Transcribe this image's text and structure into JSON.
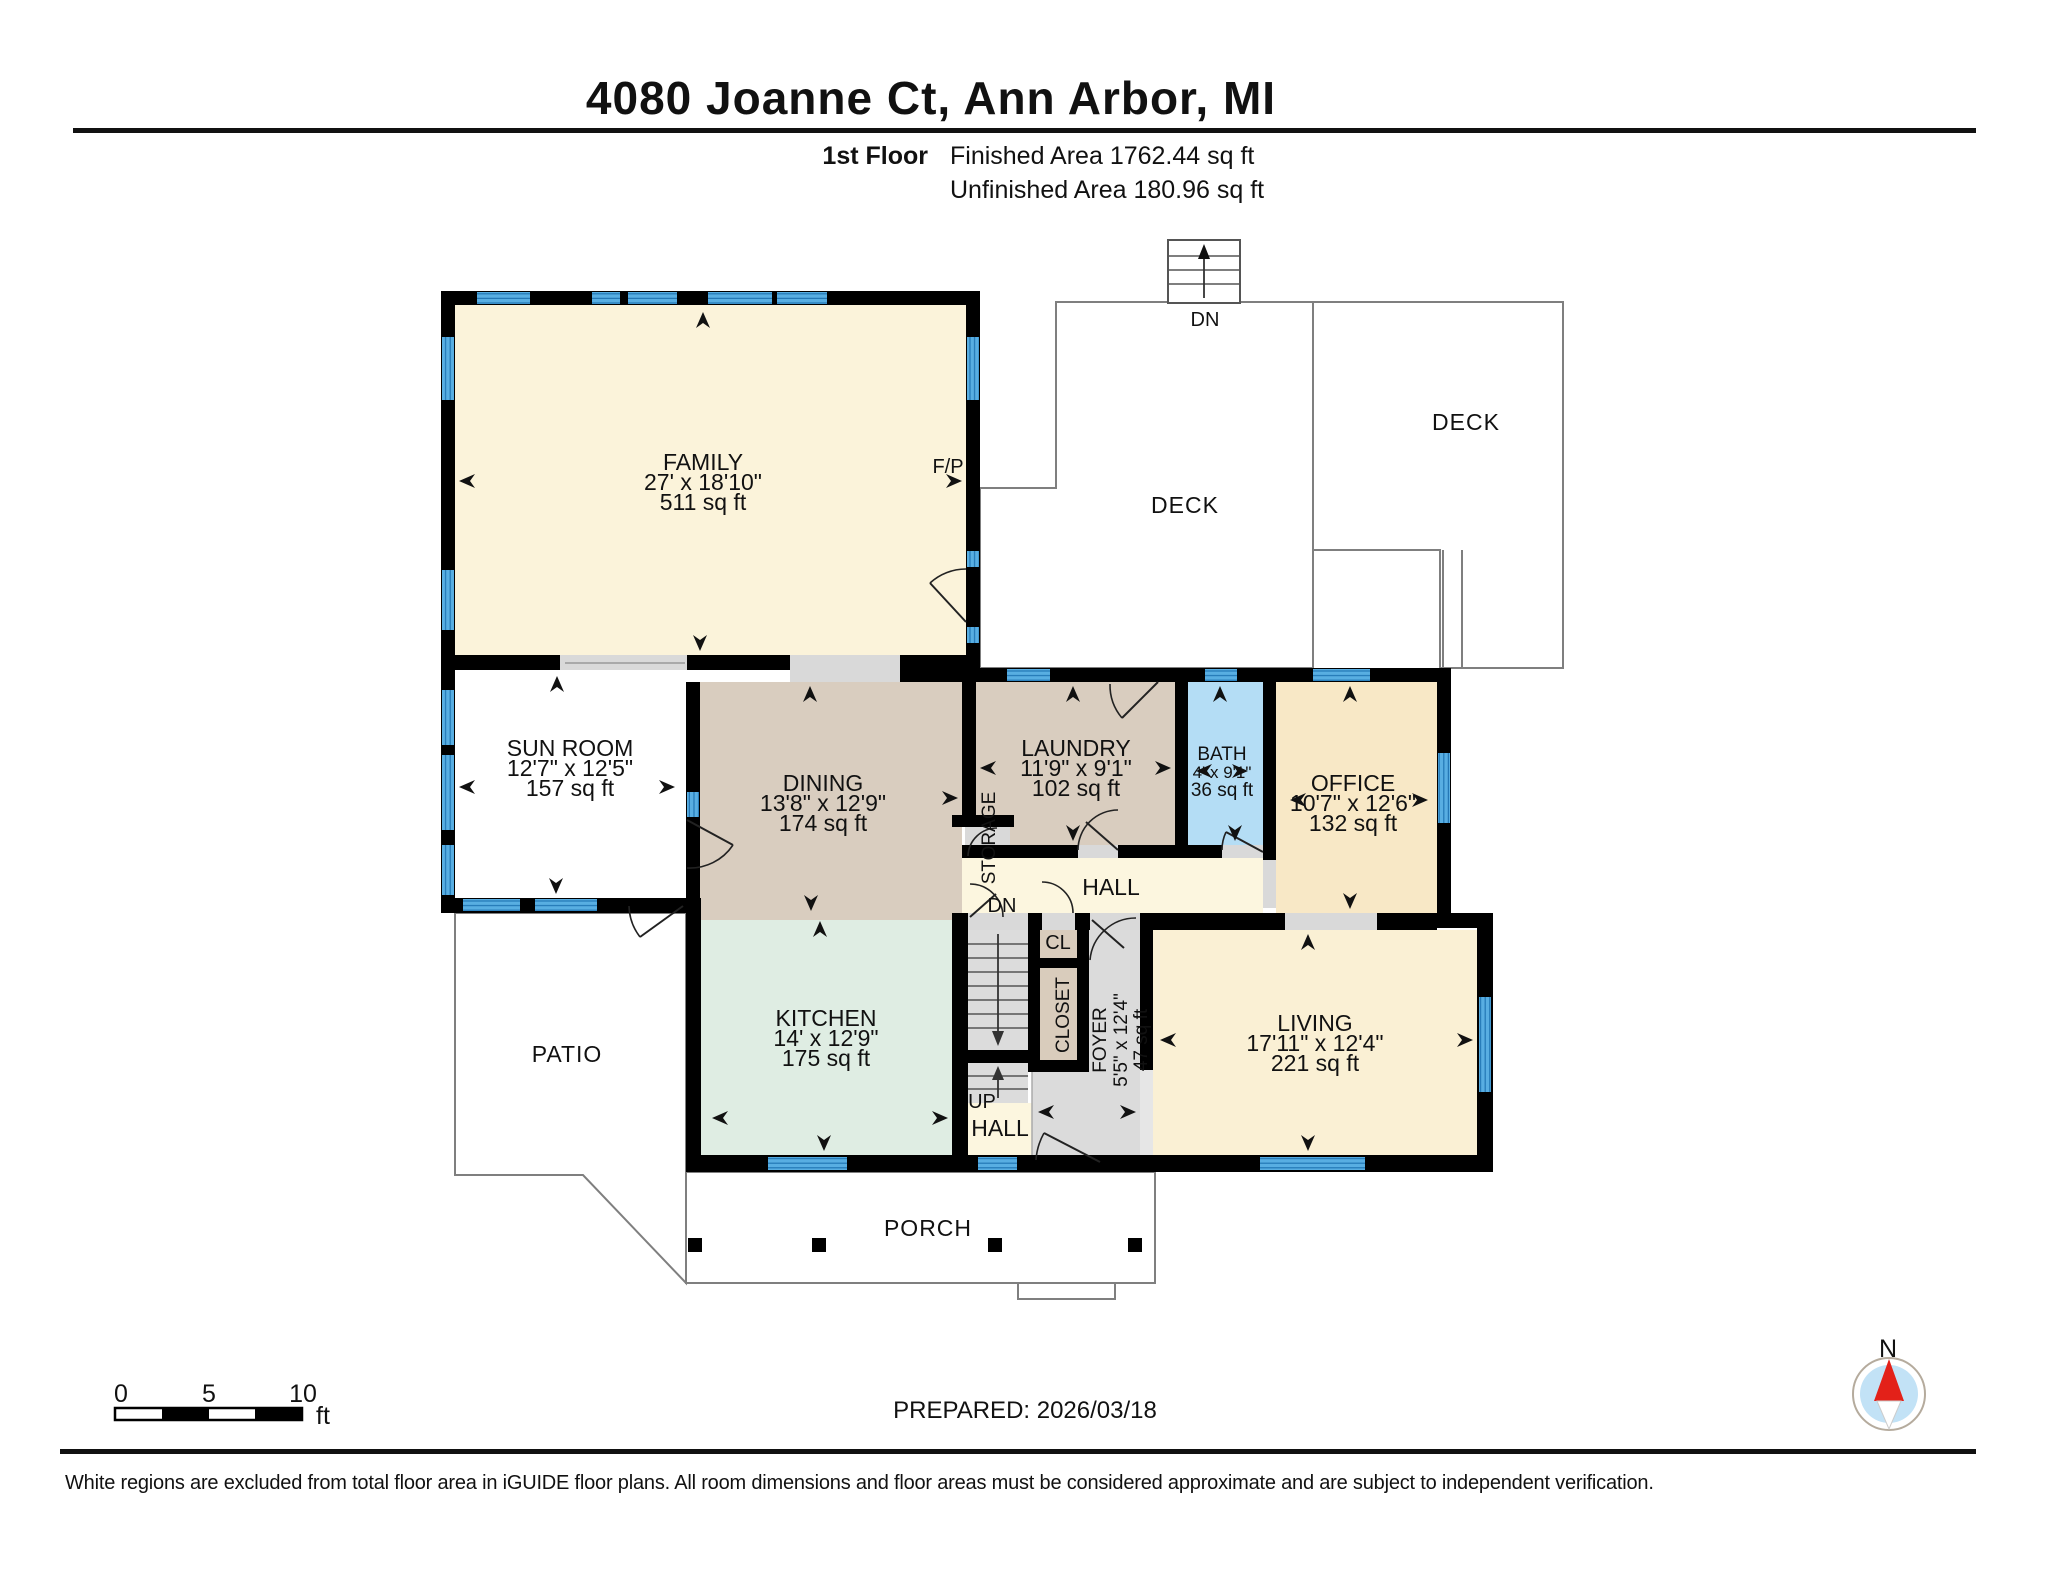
{
  "header": {
    "title": "4080 Joanne Ct, Ann Arbor, MI",
    "floor_label": "1st Floor",
    "finished": "Finished Area 1762.44 sq ft",
    "unfinished": "Unfinished Area 180.96 sq ft"
  },
  "rooms": {
    "family": {
      "name": "FAMILY",
      "dims": "27' x 18'10\"",
      "area": "511 sq ft"
    },
    "sunroom": {
      "name": "SUN ROOM",
      "dims": "12'7\" x 12'5\"",
      "area": "157 sq ft"
    },
    "dining": {
      "name": "DINING",
      "dims": "13'8\" x 12'9\"",
      "area": "174 sq ft"
    },
    "laundry": {
      "name": "LAUNDRY",
      "dims": "11'9\" x 9'1\"",
      "area": "102 sq ft"
    },
    "bath": {
      "name": "BATH",
      "dims": "4' x 9'1\"",
      "area": "36 sq ft"
    },
    "office": {
      "name": "OFFICE",
      "dims": "10'7\" x 12'6\"",
      "area": "132 sq ft"
    },
    "kitchen": {
      "name": "KITCHEN",
      "dims": "14' x 12'9\"",
      "area": "175 sq ft"
    },
    "living": {
      "name": "LIVING",
      "dims": "17'11\" x 12'4\"",
      "area": "221 sq ft"
    },
    "foyer": {
      "name": "FOYER",
      "dims": "5'5\" x 12'4\"",
      "area": "47 sq ft"
    },
    "hall_upper": "HALL",
    "hall_lower": "HALL",
    "closet": "CLOSET",
    "cl": "CL",
    "storage": "STORAGE"
  },
  "outdoor": {
    "deck_left": "DECK",
    "deck_right": "DECK",
    "patio": "PATIO",
    "porch": "PORCH"
  },
  "annotations": {
    "dn_deck": "DN",
    "dn_stair": "DN",
    "up": "UP",
    "fp": "F/P"
  },
  "scale_bar": {
    "t0": "0",
    "t5": "5",
    "t10": "10",
    "unit": "ft"
  },
  "compass": {
    "label": "N"
  },
  "prepared": "PREPARED: 2026/03/18",
  "footer": "White regions are excluded from total floor area in iGUIDE floor plans. All room dimensions and floor areas must be considered approximate and are subject to independent verification.",
  "colors": {
    "wall": "#000000",
    "window": "#58aee2",
    "window_line": "#2277b5",
    "family": "#fbf3da",
    "dining_tan": "#d9cdbf",
    "kitchen_green": "#dfede3",
    "bath_blue": "#b4ddf5",
    "office_cream": "#f8e8c6",
    "hall_cream": "#fcf6df",
    "living_cream": "#faf0d4",
    "foyer_gray": "#dbdbdb",
    "closet_tan": "#d9ccbc",
    "compass_red": "#e32119",
    "compass_blue": "#c2e2f6"
  }
}
